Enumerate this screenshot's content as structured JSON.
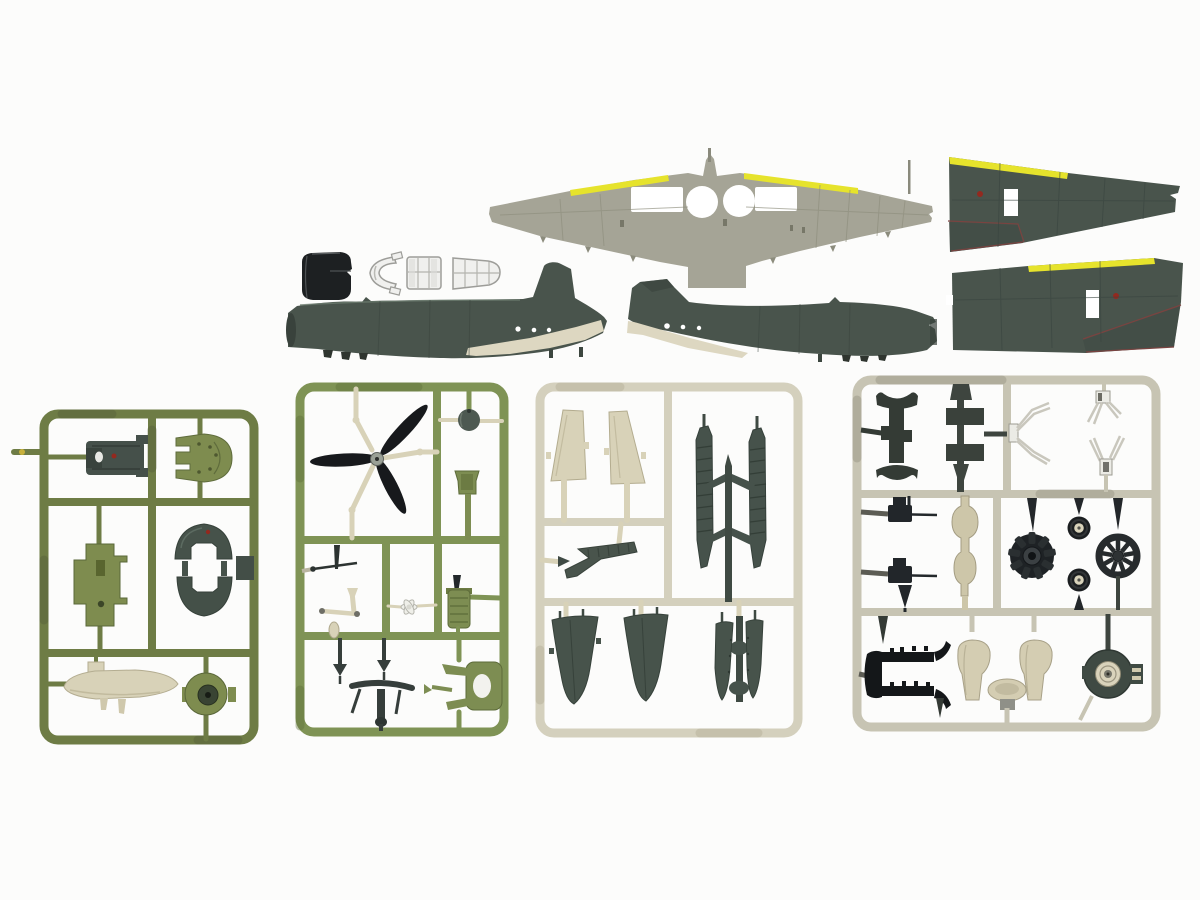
{
  "palette": {
    "background": "#fcfcfb",
    "sage": "#a5a496",
    "sage_dark": "#8c8c7d",
    "dark_green": "#49544c",
    "dark_green_deep": "#39423c",
    "dark_green_light": "#5d6a60",
    "leading_edge_yellow": "#e6e32c",
    "belly_cream": "#ddd7c1",
    "black_part": "#1d2022",
    "clear_fill": "#f0f0ee",
    "clear_stroke": "#9d9d99",
    "olive_frame": "#6e7c45",
    "olive_part": "#7e8c4f",
    "green_frame": "#7f9355",
    "cream_frame": "#d4d0bd",
    "cream_part": "#d8d2b8",
    "putty_frame": "#c7c4b3",
    "gun_metal": "#22262a",
    "tire_black": "#1b1e20",
    "hub_cream": "#d9d3bb",
    "wire_light": "#ebebe5",
    "wire_line": "#bdbbb1",
    "red_marking": "#93291f"
  },
  "loose_parts": {
    "lower_wing": {
      "label": "one-piece lower wing with yellow leading-edge strips and round wheel-well openings"
    },
    "upper_wing_panel_1": {
      "label": "upper wing panel with yellow outer leading edge (upper right of photo)"
    },
    "upper_wing_panel_2": {
      "label": "upper wing panel with yellow outer leading edge (lower right of photo)"
    },
    "fuselage_half_left": {
      "label": "dark green fuselage half with cream lower rear, nose to left"
    },
    "fuselage_half_right": {
      "label": "dark green fuselage half with cream lower rear, nose to right"
    },
    "cowling": {
      "label": "black engine cowling section"
    },
    "windscreen": {
      "label": "clear windscreen part"
    },
    "canopy_mid": {
      "label": "clear canopy centre greenhouse section"
    },
    "canopy_rear": {
      "label": "clear canopy rear greenhouse section"
    }
  },
  "sprues": [
    {
      "label": "olive green sprue with cockpit and cowl parts",
      "parts": [
        "engine mount block",
        "cockpit deck",
        "firewall bulkhead",
        "cowl top dome",
        "cowl bottom dome",
        "square plate",
        "cream drop tank",
        "cowling ring"
      ]
    },
    {
      "label": "green sprue with propeller and small fittings",
      "parts": [
        "three-blade black propeller",
        "spinner ball",
        "pilot seat",
        "antenna mast",
        "cream control crank",
        "small hub wheel",
        "finned oil cooler",
        "tail-wheel strut set",
        "engine mount fork"
      ]
    },
    {
      "label": "cream sprue with tailplanes, flaps and gear covers",
      "parts": [
        "tailplane half",
        "tailplane half",
        "ribbed flap section",
        "flap rack with two ribbed strips",
        "main gear cover",
        "main gear cover",
        "inner gear door pair on rod"
      ]
    },
    {
      "label": "grey sprue with engine, wheels, guns and detail parts",
      "parts": [
        "bomb rack with sway braces",
        "small fuselage blocks",
        "white retraction strut wires",
        "machine gun",
        "machine gun",
        "cream oleo strut column",
        "black radial engine",
        "main wheel",
        "main wheel",
        "spoked cylinder ring",
        "black exhaust manifold",
        "cream seat support",
        "cream seat support",
        "equipment tray",
        "engine gear housing"
      ]
    }
  ]
}
